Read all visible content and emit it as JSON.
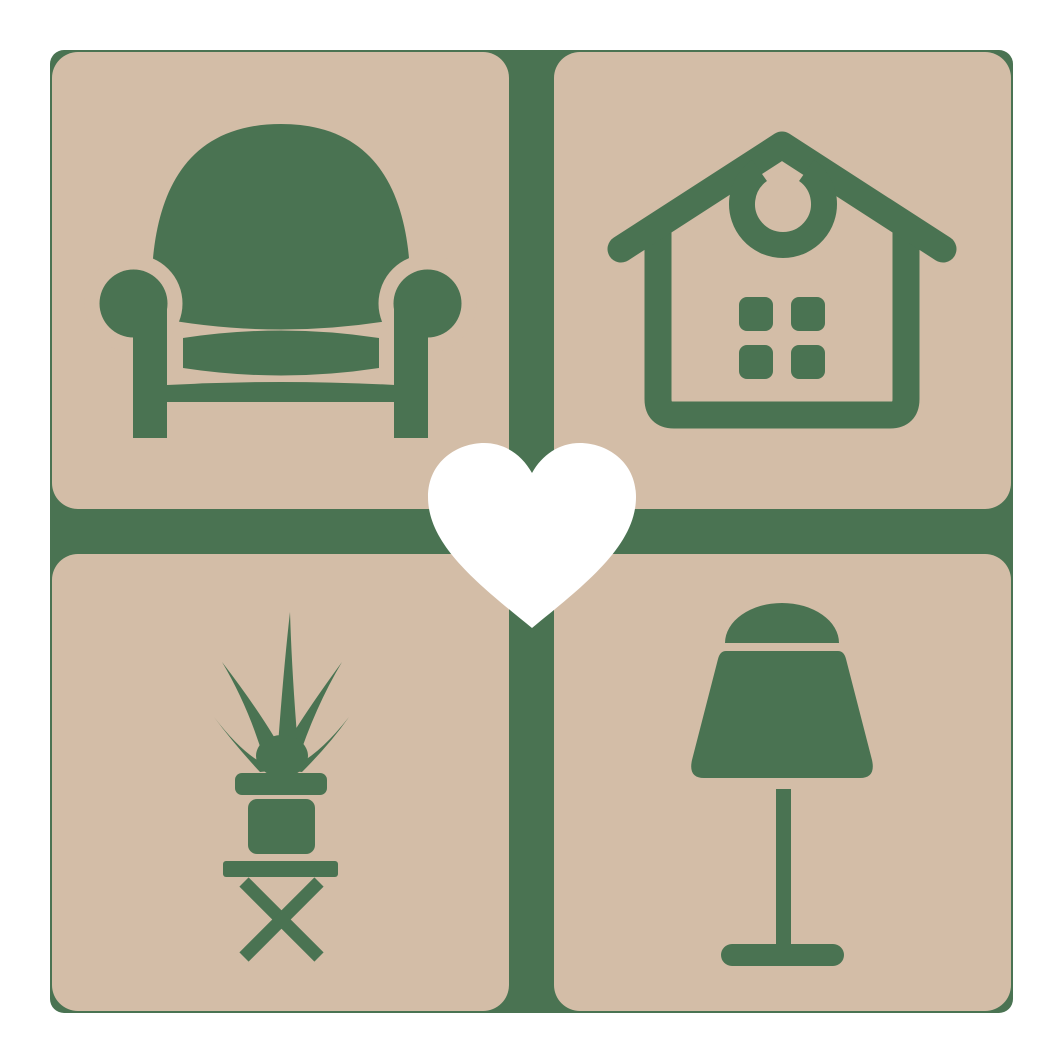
{
  "logo": {
    "kind": "home-furniture-logo",
    "grid": {
      "rows": 2,
      "cols": 2
    },
    "tiles": [
      {
        "position": "top-left",
        "icon": "armchair-icon"
      },
      {
        "position": "top-right",
        "icon": "house-icon"
      },
      {
        "position": "bottom-left",
        "icon": "potted-plant-icon"
      },
      {
        "position": "bottom-right",
        "icon": "table-lamp-icon"
      }
    ],
    "center": {
      "icon": "heart-icon"
    }
  },
  "colors": {
    "canvas_bg": "#ffffff",
    "frame_green": "#4a7352",
    "tile_tan": "#d3bda7",
    "heart_white": "#ffffff"
  }
}
